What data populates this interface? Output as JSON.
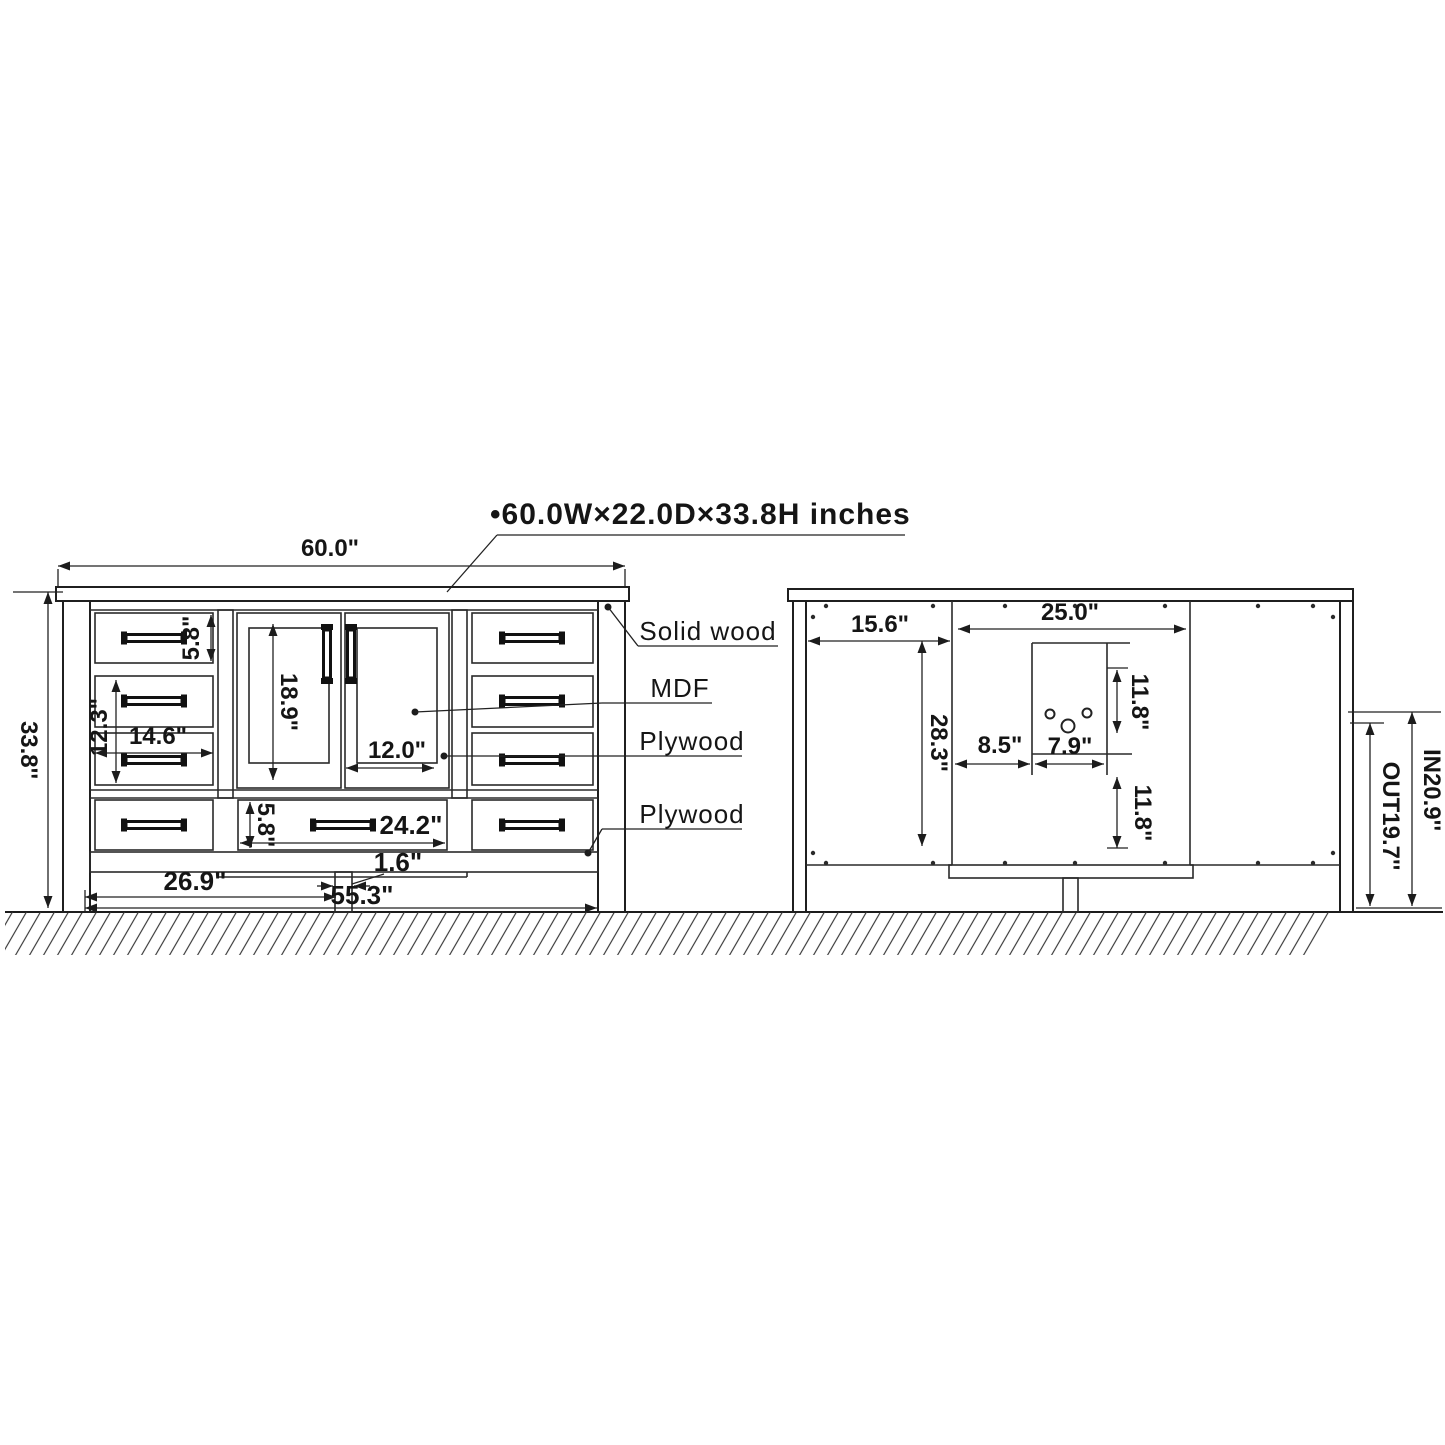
{
  "title": "•60.0W×22.0D×33.8H inches",
  "front": {
    "total_width": "60.0\"",
    "total_height": "33.8''",
    "top_drawer_height": "5.8\"",
    "side_drawer_stack": "12.3\"",
    "side_drawer_width": "14.6\"",
    "door_height": "18.9\"",
    "door_width": "12.0\"",
    "bottom_drawer_height": "5.8\"",
    "bottom_drawer_width": "24.2\"",
    "center_leg_width": "1.6\"",
    "left_to_leg": "26.9\"",
    "base_width": "55.3\"",
    "material_top": "Solid wood",
    "material_doors": "MDF",
    "material_mid": "Plywood",
    "material_bottom": "Plywood"
  },
  "back": {
    "side_panel_width": "15.6\"",
    "center_panel_width": "25.0\"",
    "panel_height": "28.3\"",
    "cutout_offset": "8.5\"",
    "cutout_width": "7.9\"",
    "upper_clearance": "11.8\"",
    "lower_clearance": "11.8\"",
    "drain_out": "OUT19.7''",
    "drain_in": "IN20.9''"
  }
}
